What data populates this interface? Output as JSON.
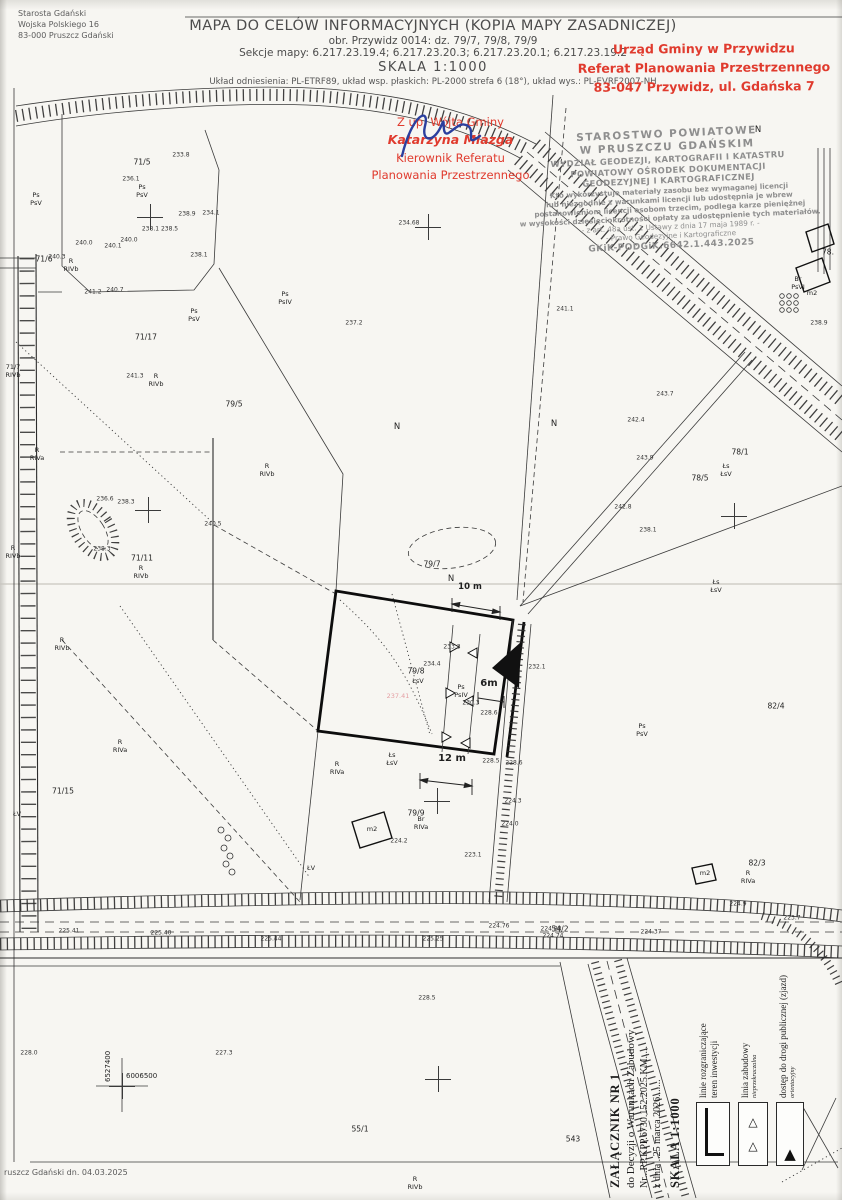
{
  "header": {
    "sender": "Starosta Gdański\nWojska Polskiego 16\n83-000 Pruszcz Gdański",
    "title": "MAPA DO CELÓW INFORMACYJNYCH (KOPIA MAPY ZASADNICZEJ)",
    "subtitle1": "obr. Przywidz 0014: dz. 79/7, 79/8, 79/9",
    "subtitle2": "Sekcje mapy: 6.217.23.19.4; 6.217.23.20.3; 6.217.23.20.1; 6.217.23.19.2",
    "scale": "SKALA 1:1000",
    "datum": "Układ odniesienia: PL-ETRF89, układ wsp. płaskich: PL-2000 strefa 6 (18°), układ wys.: PL-EVRF2007-NH"
  },
  "stamps": {
    "municipal": {
      "line1": "Urząd Gminy w Przywidzu",
      "line2": "Referat Planowania Przestrzennego",
      "line3": "83-047 Przywidz, ul. Gdańska 7",
      "color": "#e03b2e"
    },
    "signature": {
      "line1": "Z up. Wójta Gminy",
      "name": "Katarzyna Miazga",
      "line3": "Kierownik Referatu",
      "line4": "Planowania Przestrzennego"
    },
    "county_lines": [
      {
        "t": "STAROSTWO POWIATOWE",
        "c": "s1"
      },
      {
        "t": "W PRUSZCZU GDAŃSKIM",
        "c": "s1"
      },
      {
        "t": "WYDZIAŁ GEODEZJI, KARTOGRAFII I KATASTRU",
        "c": "s2"
      },
      {
        "t": "POWIATOWY OŚRODEK DOKUMENTACJI",
        "c": "s2"
      },
      {
        "t": "GEODEZYJNEJ I KARTOGRAFICZNEJ",
        "c": "s2"
      },
      {
        "t": "Kto wykorzystuje materiały zasobu bez wymaganej licencji",
        "c": "s3"
      },
      {
        "t": "lub niezgodnie z warunkami licencji lub udostępnia je wbrew",
        "c": "s3"
      },
      {
        "t": "postanowieniom licencji osobom trzecim, podlega karze pieniężnej",
        "c": "s3"
      },
      {
        "t": "w wysokości dziesięciokrotności opłaty za udostępnienie tych materiałów.",
        "c": "s3"
      },
      {
        "t": "- z art. 48a ust. 1 Ustawy z dnia 17 maja 1989 r. -",
        "c": "s4"
      },
      {
        "t": "- Prawo Geodezyjne i Kartograficzne",
        "c": "s4"
      },
      {
        "t": "GKiK-PODGiK.6642.1.443.2025",
        "c": "s5"
      }
    ]
  },
  "map": {
    "labels": [
      {
        "t": "71/6",
        "x": 44,
        "y": 259,
        "c": "p"
      },
      {
        "t": "71/5",
        "x": 142,
        "y": 162,
        "c": "p"
      },
      {
        "t": "71/17",
        "x": 146,
        "y": 337,
        "c": "p"
      },
      {
        "t": "79/5",
        "x": 234,
        "y": 404,
        "c": "p"
      },
      {
        "t": "71/11",
        "x": 142,
        "y": 558,
        "c": "p"
      },
      {
        "t": "71/15",
        "x": 63,
        "y": 791,
        "c": "p"
      },
      {
        "t": "79/7",
        "x": 432,
        "y": 564,
        "c": "p"
      },
      {
        "t": "79/8",
        "x": 416,
        "y": 671,
        "c": "p"
      },
      {
        "t": "79/9",
        "x": 416,
        "y": 813,
        "c": "p"
      },
      {
        "t": "78/5",
        "x": 700,
        "y": 478,
        "c": "p"
      },
      {
        "t": "78/1",
        "x": 740,
        "y": 452,
        "c": "p"
      },
      {
        "t": "82/4",
        "x": 776,
        "y": 706,
        "c": "p"
      },
      {
        "t": "82/3",
        "x": 757,
        "y": 863,
        "c": "p"
      },
      {
        "t": "54/2",
        "x": 560,
        "y": 929,
        "c": "p"
      },
      {
        "t": "55/1",
        "x": 360,
        "y": 1129,
        "c": "p"
      },
      {
        "t": "543",
        "x": 573,
        "y": 1139,
        "c": "p"
      },
      {
        "t": "78.",
        "x": 828,
        "y": 252,
        "c": "p"
      },
      {
        "t": "Ps\nPsV",
        "x": 36,
        "y": 200,
        "c": "s"
      },
      {
        "t": "Ps\nPsV",
        "x": 142,
        "y": 192,
        "c": "s"
      },
      {
        "t": "Ps\nPsV",
        "x": 194,
        "y": 316,
        "c": "s"
      },
      {
        "t": "Ps\nPsIV",
        "x": 285,
        "y": 299,
        "c": "s"
      },
      {
        "t": "R\nRIVb",
        "x": 71,
        "y": 266,
        "c": "s"
      },
      {
        "t": "71/7\nRIVb",
        "x": 13,
        "y": 372,
        "c": "s"
      },
      {
        "t": "R\nRIVb",
        "x": 156,
        "y": 381,
        "c": "s"
      },
      {
        "t": "R\nRIVb",
        "x": 267,
        "y": 471,
        "c": "s"
      },
      {
        "t": "R\nRIVb",
        "x": 141,
        "y": 573,
        "c": "s"
      },
      {
        "t": "R\nRIVb",
        "x": 13,
        "y": 553,
        "c": "s"
      },
      {
        "t": "R\nRIVa",
        "x": 37,
        "y": 455,
        "c": "s"
      },
      {
        "t": "R\nRIVb",
        "x": 62,
        "y": 645,
        "c": "s"
      },
      {
        "t": "R\nRIVa",
        "x": 120,
        "y": 747,
        "c": "s"
      },
      {
        "t": "R\nRIVa",
        "x": 337,
        "y": 769,
        "c": "s"
      },
      {
        "t": "Łs\nŁsV",
        "x": 392,
        "y": 760,
        "c": "s"
      },
      {
        "t": "Łs\nŁsV",
        "x": 726,
        "y": 471,
        "c": "s"
      },
      {
        "t": "Łs\nŁsV",
        "x": 716,
        "y": 587,
        "c": "s"
      },
      {
        "t": "ŁsV",
        "x": 418,
        "y": 682,
        "c": "s"
      },
      {
        "t": "Ps\nPsIV",
        "x": 461,
        "y": 692,
        "c": "s"
      },
      {
        "t": "Ps\nPsV",
        "x": 642,
        "y": 731,
        "c": "s"
      },
      {
        "t": "Br\nRIVa",
        "x": 421,
        "y": 824,
        "c": "s"
      },
      {
        "t": "Br\nPsVI",
        "x": 798,
        "y": 284,
        "c": "s"
      },
      {
        "t": "R\nRIVa",
        "x": 748,
        "y": 878,
        "c": "s"
      },
      {
        "t": "ŁV",
        "x": 17,
        "y": 815,
        "c": "s"
      },
      {
        "t": "ŁV",
        "x": 311,
        "y": 869,
        "c": "s"
      },
      {
        "t": "R\nRIVb",
        "x": 415,
        "y": 1184,
        "c": "s"
      },
      {
        "t": "m2",
        "x": 372,
        "y": 830,
        "c": "s"
      },
      {
        "t": "m2",
        "x": 812,
        "y": 294,
        "c": "s"
      },
      {
        "t": "m2",
        "x": 705,
        "y": 874,
        "c": "s"
      },
      {
        "t": "233.8",
        "x": 181,
        "y": 155,
        "c": "e"
      },
      {
        "t": "236.1",
        "x": 131,
        "y": 179,
        "c": "e"
      },
      {
        "t": "238.9",
        "x": 187,
        "y": 214,
        "c": "e"
      },
      {
        "t": "234.1",
        "x": 211,
        "y": 213,
        "c": "e"
      },
      {
        "t": "238.1 238.5",
        "x": 160,
        "y": 229,
        "c": "e"
      },
      {
        "t": "240.0",
        "x": 129,
        "y": 240,
        "c": "e"
      },
      {
        "t": "240.1",
        "x": 113,
        "y": 246,
        "c": "e"
      },
      {
        "t": "240.0",
        "x": 84,
        "y": 243,
        "c": "e"
      },
      {
        "t": "238.1",
        "x": 199,
        "y": 255,
        "c": "e"
      },
      {
        "t": "240.3",
        "x": 57,
        "y": 257,
        "c": "e"
      },
      {
        "t": "241.2",
        "x": 93,
        "y": 292,
        "c": "e"
      },
      {
        "t": "240.7",
        "x": 115,
        "y": 290,
        "c": "e"
      },
      {
        "t": "241.3",
        "x": 135,
        "y": 376,
        "c": "e"
      },
      {
        "t": "234.68",
        "x": 409,
        "y": 223,
        "c": "e"
      },
      {
        "t": "237.2",
        "x": 354,
        "y": 323,
        "c": "e"
      },
      {
        "t": "241.1",
        "x": 565,
        "y": 309,
        "c": "e"
      },
      {
        "t": "242.4",
        "x": 636,
        "y": 420,
        "c": "e"
      },
      {
        "t": "243.7",
        "x": 665,
        "y": 394,
        "c": "e"
      },
      {
        "t": "243.9",
        "x": 645,
        "y": 458,
        "c": "e"
      },
      {
        "t": "242.8",
        "x": 623,
        "y": 507,
        "c": "e"
      },
      {
        "t": "238.1",
        "x": 648,
        "y": 530,
        "c": "e"
      },
      {
        "t": "236.6",
        "x": 105,
        "y": 499,
        "c": "e"
      },
      {
        "t": "238.3",
        "x": 126,
        "y": 502,
        "c": "e"
      },
      {
        "t": "238.3",
        "x": 102,
        "y": 549,
        "c": "e"
      },
      {
        "t": "240.5",
        "x": 213,
        "y": 524,
        "c": "e"
      },
      {
        "t": "234.4",
        "x": 432,
        "y": 664,
        "c": "e"
      },
      {
        "t": "233.3",
        "x": 452,
        "y": 647,
        "c": "e"
      },
      {
        "t": "230.3",
        "x": 471,
        "y": 703,
        "c": "e"
      },
      {
        "t": "228.6",
        "x": 489,
        "y": 713,
        "c": "e"
      },
      {
        "t": "232.1",
        "x": 537,
        "y": 667,
        "c": "e"
      },
      {
        "t": "228.5",
        "x": 491,
        "y": 761,
        "c": "e"
      },
      {
        "t": "228.6",
        "x": 514,
        "y": 763,
        "c": "e"
      },
      {
        "t": "224.2",
        "x": 399,
        "y": 841,
        "c": "e"
      },
      {
        "t": "224.3",
        "x": 513,
        "y": 801,
        "c": "e"
      },
      {
        "t": "224.0",
        "x": 510,
        "y": 824,
        "c": "e"
      },
      {
        "t": "223.1",
        "x": 473,
        "y": 855,
        "c": "e"
      },
      {
        "t": "225.41",
        "x": 69,
        "y": 931,
        "c": "e"
      },
      {
        "t": "225.40",
        "x": 161,
        "y": 933,
        "c": "e"
      },
      {
        "t": "225.44",
        "x": 271,
        "y": 939,
        "c": "e"
      },
      {
        "t": "225.25",
        "x": 433,
        "y": 939,
        "c": "e"
      },
      {
        "t": "224.76",
        "x": 499,
        "y": 926,
        "c": "e"
      },
      {
        "t": "224.88",
        "x": 551,
        "y": 929,
        "c": "e"
      },
      {
        "t": "224.74",
        "x": 553,
        "y": 936,
        "c": "e"
      },
      {
        "t": "224.37",
        "x": 651,
        "y": 932,
        "c": "e"
      },
      {
        "t": "223.7",
        "x": 792,
        "y": 918,
        "c": "e"
      },
      {
        "t": "224.9",
        "x": 738,
        "y": 904,
        "c": "e"
      },
      {
        "t": "228.0",
        "x": 29,
        "y": 1053,
        "c": "e"
      },
      {
        "t": "227.3",
        "x": 224,
        "y": 1053,
        "c": "e"
      },
      {
        "t": "228.5",
        "x": 427,
        "y": 998,
        "c": "e"
      },
      {
        "t": "238.9",
        "x": 819,
        "y": 323,
        "c": "e"
      },
      {
        "t": "N",
        "x": 397,
        "y": 427,
        "c": "n"
      },
      {
        "t": "N",
        "x": 554,
        "y": 424,
        "c": "n"
      },
      {
        "t": "N",
        "x": 451,
        "y": 579,
        "c": "n"
      },
      {
        "t": "N",
        "x": 758,
        "y": 130,
        "c": "n"
      },
      {
        "t": "237.41",
        "x": 398,
        "y": 697,
        "c": "g"
      },
      {
        "t": "10 m",
        "x": 470,
        "y": 587,
        "c": "dim"
      },
      {
        "t": "6m",
        "x": 489,
        "y": 684,
        "c": "dimbig"
      },
      {
        "t": "12 m",
        "x": 452,
        "y": 759,
        "c": "dimbig"
      }
    ],
    "crosses": [
      {
        "x": 150,
        "y": 217
      },
      {
        "x": 428,
        "y": 227
      },
      {
        "x": 148,
        "y": 510
      },
      {
        "x": 734,
        "y": 516
      },
      {
        "x": 437,
        "y": 801
      },
      {
        "x": 438,
        "y": 1079
      },
      {
        "x": 122,
        "y": 1086
      }
    ],
    "coords": {
      "vertical": "6527400",
      "horizontal": "6006500"
    }
  },
  "legend": {
    "attachment": {
      "line1": "ZAŁĄCZNIK NR 1",
      "line2": "do Decyzji o Warunkach Zabudowy",
      "line3": "Nr...RP.KPP.6730.152.2025.KM.....",
      "line4": "z dnia ..25 marca 2026.......",
      "line5": "SKALA 1:1000"
    },
    "items": [
      {
        "label": "linie rozgraniczające\nteren inwestycji",
        "note": "",
        "symbol": "boundary",
        "x": 696,
        "y": 1102
      },
      {
        "label": "linia zabudowy",
        "note": "nieprzekraczalna",
        "symbol": "setback",
        "x": 738,
        "y": 1102
      },
      {
        "label": "dostęp do drogi publicznej (zjazd)",
        "note": "orientacyjny",
        "symbol": "access",
        "x": 776,
        "y": 1102
      }
    ]
  },
  "footer": {
    "note": "ruszcz Gdański dn. 04.03.2025"
  }
}
